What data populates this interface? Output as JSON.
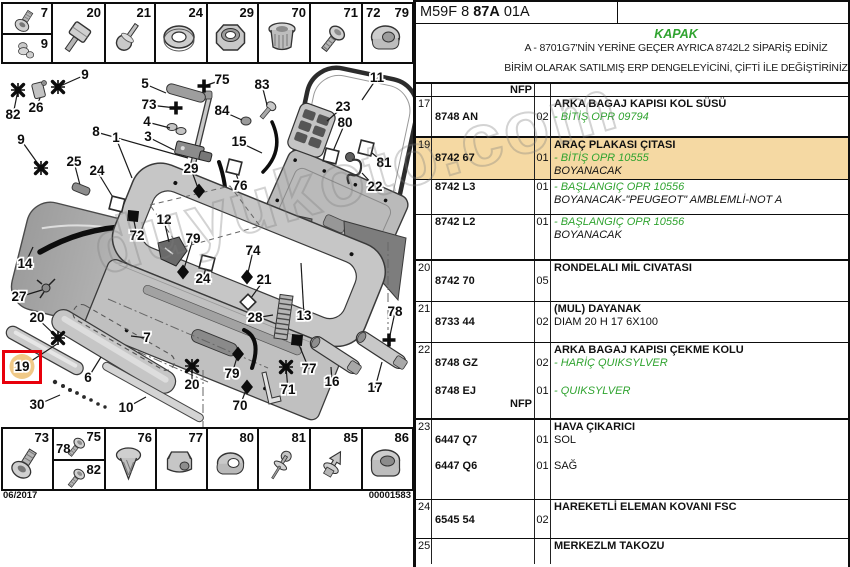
{
  "watermark": {
    "text": "duyukoto.com"
  },
  "header": {
    "code_prefix": "M59F 8 ",
    "code_bold": "87A",
    "code_suffix": " 01A"
  },
  "title_block": {
    "title": "KAPAK",
    "title_color": "#2fa32f",
    "note1": "A - 8701G7'NİN YERİNE GEÇER AYRICA 8742L2 SİPARİŞ EDİNİZ",
    "note2": "BİRİM OLARAK SATILMIŞ ERP DENGELEYİCİNİ, ÇİFTİ İLE DEĞİŞTİRİNİZ"
  },
  "parts_table": {
    "green": "#2fa32f",
    "highlight": "#f5d9a3",
    "nfp_label": "NFP",
    "rows": [
      {
        "ref": "17",
        "part": "8748 AN",
        "qty": "02",
        "titled": true,
        "h": 41,
        "bb": 2,
        "lines": [
          [
            "k",
            "ARKA BAGAJ KAPISI KOL SÜSÜ"
          ],
          [
            "g",
            "- BİTİŞ OPR 09794"
          ]
        ]
      },
      {
        "ref": "19",
        "part": "8742 67",
        "qty": "01",
        "titled": true,
        "h": 42,
        "bb": 1,
        "hl": true,
        "lines": [
          [
            "k",
            "ARAÇ PLAKASI ÇITASI"
          ],
          [
            "g",
            "- BİTİŞ OPR 10555"
          ],
          [
            "i",
            "BOYANACAK"
          ]
        ]
      },
      {
        "part": "8742 L3",
        "qty": "01",
        "h": 35,
        "bb": 1,
        "lines": [
          [
            "g",
            "- BAŞLANGIÇ OPR 10556"
          ],
          [
            "i",
            "BOYANACAK-\"PEUGEOT\" AMBLEMLİ-NOT A"
          ]
        ]
      },
      {
        "part": "8742 L2",
        "qty": "01",
        "h": 46,
        "bb": 2,
        "lines": [
          [
            "g",
            "- BAŞLANGIÇ OPR 10556"
          ],
          [
            "i",
            "BOYANACAK"
          ]
        ]
      },
      {
        "ref": "20",
        "part": "8742 70",
        "qty": "05",
        "titled": true,
        "h": 41,
        "bb": 1,
        "lines": [
          [
            "k",
            "RONDELALI MİL CIVATASI"
          ]
        ]
      },
      {
        "ref": "21",
        "part": "8733 44",
        "qty": "02",
        "titled": true,
        "h": 41,
        "bb": 1,
        "lines": [
          [
            "k",
            "(MUL) DAYANAK"
          ],
          [
            "n",
            "DIAM 20 H 17 6X100"
          ]
        ]
      },
      {
        "ref": "22",
        "part": "8748 GZ",
        "qty": "02",
        "titled": true,
        "h": 41,
        "bb": 0,
        "lines": [
          [
            "k",
            "ARKA BAGAJ KAPISI ÇEKME KOLU"
          ],
          [
            "g",
            "- HARİÇ QUIKSYLVER"
          ]
        ]
      },
      {
        "part": "8748 EJ",
        "qty": "01",
        "nfp": true,
        "h": 36,
        "bb": 2,
        "lines": [
          [
            "g",
            "- QUIKSYLVER"
          ]
        ]
      },
      {
        "ref": "23",
        "part": "6447 Q7",
        "qty": "01",
        "titled": true,
        "h": 39,
        "bb": 0,
        "lines": [
          [
            "k",
            "HAVA ÇIKARICI"
          ],
          [
            "n",
            "SOL"
          ]
        ]
      },
      {
        "part": "6447 Q6",
        "qty": "01",
        "h": 41,
        "bb": 1,
        "lines": [
          [
            "n",
            "SAĞ"
          ]
        ]
      },
      {
        "ref": "24",
        "part": "6545 54",
        "qty": "02",
        "titled": true,
        "h": 39,
        "bb": 1,
        "lines": [
          [
            "k",
            "HAREKETLİ ELEMAN KOVANI FSC"
          ]
        ]
      },
      {
        "ref": "25",
        "titled": true,
        "h": 25,
        "bb": 0,
        "lines": [
          [
            "k",
            "MERKEZLM TAKOZU"
          ]
        ]
      }
    ]
  },
  "diagram": {
    "sheet_date": "06/2017",
    "sheet_number": "00001583",
    "highlight_color": "#f0c987",
    "top_fasteners": [
      {
        "x": 2,
        "w": 50,
        "split": [
          {
            "label": "7",
            "icon": "socketbolt"
          },
          {
            "label": "9",
            "icon": "stud"
          }
        ]
      },
      {
        "x": 52,
        "w": 53,
        "label": "20",
        "icon": "squarebolt"
      },
      {
        "x": 105,
        "w": 50,
        "label": "21",
        "icon": "pin"
      },
      {
        "x": 155,
        "w": 52,
        "label": "24",
        "icon": "washer"
      },
      {
        "x": 207,
        "w": 51,
        "label": "29",
        "icon": "hexnut"
      },
      {
        "x": 258,
        "w": 52,
        "label": "70",
        "icon": "cage"
      },
      {
        "x": 310,
        "w": 52,
        "label": "71",
        "icon": "screw"
      },
      {
        "x": 362,
        "w": 51,
        "labels": [
          "72",
          "79"
        ],
        "icon": "flange"
      }
    ],
    "bottom_fasteners": [
      {
        "x": 2,
        "w": 51,
        "label": "73",
        "icon": "socketbolt"
      },
      {
        "x": 53,
        "w": 52,
        "split": [
          {
            "labels": [
              "75",
              "78"
            ],
            "icon": "screw"
          },
          {
            "label": "82",
            "icon": "screw"
          }
        ]
      },
      {
        "x": 105,
        "w": 51,
        "label": "76",
        "icon": "expander"
      },
      {
        "x": 156,
        "w": 51,
        "label": "77",
        "icon": "plasticnut"
      },
      {
        "x": 207,
        "w": 51,
        "label": "80",
        "icon": "grommet"
      },
      {
        "x": 258,
        "w": 52,
        "label": "81",
        "icon": "rivet"
      },
      {
        "x": 310,
        "w": 52,
        "label": "85",
        "icon": "pushpin"
      },
      {
        "x": 362,
        "w": 51,
        "label": "86",
        "icon": "bushing"
      }
    ],
    "callouts": [
      {
        "n": "1",
        "x": 116,
        "y": 142,
        "tx": 132,
        "ty": 178
      },
      {
        "n": "3",
        "x": 148,
        "y": 141,
        "tx": 174,
        "ty": 150
      },
      {
        "n": "4",
        "x": 147,
        "y": 126,
        "tx": 170,
        "ty": 128
      },
      {
        "n": "5",
        "x": 145,
        "y": 88,
        "tx": 166,
        "ty": 93
      },
      {
        "n": "6",
        "x": 88,
        "y": 382,
        "tx": 101,
        "ty": 357
      },
      {
        "n": "7",
        "x": 147,
        "y": 342,
        "tx": 131,
        "ty": 336
      },
      {
        "n": "8",
        "x": 96,
        "y": 136,
        "tx": 188,
        "ty": 158
      },
      {
        "n": "9",
        "x": 85,
        "y": 79,
        "s": "star",
        "tx": 58,
        "ty": 87
      },
      {
        "n": "9",
        "x": 21,
        "y": 144,
        "s": "star",
        "tx": 41,
        "ty": 168
      },
      {
        "n": "10",
        "x": 126,
        "y": 412,
        "tx": 146,
        "ty": 397
      },
      {
        "n": "11",
        "x": 377,
        "y": 82,
        "tx": 362,
        "ty": 100
      },
      {
        "n": "12",
        "x": 164,
        "y": 224,
        "tx": 169,
        "ty": 242
      },
      {
        "n": "13",
        "x": 304,
        "y": 320,
        "tx": 301,
        "ty": 263
      },
      {
        "n": "14",
        "x": 25,
        "y": 268,
        "tx": 33,
        "ty": 247
      },
      {
        "n": "15",
        "x": 239,
        "y": 146,
        "tx": 262,
        "ty": 153
      },
      {
        "n": "16",
        "x": 332,
        "y": 386,
        "tx": 331,
        "ty": 367
      },
      {
        "n": "17",
        "x": 375,
        "y": 392,
        "tx": 382,
        "ty": 362
      },
      {
        "n": "19",
        "x": 22,
        "y": 371,
        "hl": true,
        "tx": 57,
        "ty": 344
      },
      {
        "n": "20",
        "x": 37,
        "y": 322,
        "s": "star",
        "tx": 58,
        "ty": 338
      },
      {
        "n": "20",
        "x": 192,
        "y": 389,
        "s": "star",
        "tx": 192,
        "ty": 366
      },
      {
        "n": "21",
        "x": 264,
        "y": 284,
        "s": "rhomb",
        "tx": 248,
        "ty": 302
      },
      {
        "n": "22",
        "x": 375,
        "y": 191,
        "tx": 362,
        "ty": 173
      },
      {
        "n": "23",
        "x": 343,
        "y": 111,
        "tx": 327,
        "ty": 121
      },
      {
        "n": "24",
        "x": 97,
        "y": 175,
        "s": "osq",
        "tx": 117,
        "ty": 204
      },
      {
        "n": "24",
        "x": 203,
        "y": 283,
        "s": "osq",
        "tx": 207,
        "ty": 263
      },
      {
        "n": "25",
        "x": 74,
        "y": 166,
        "s": "bar",
        "tx": 81,
        "ty": 189
      },
      {
        "n": "26",
        "x": 36,
        "y": 112,
        "tx": 40,
        "ty": 98
      },
      {
        "n": "27",
        "x": 19,
        "y": 301,
        "tx": 42,
        "ty": 290
      },
      {
        "n": "28",
        "x": 255,
        "y": 322,
        "tx": 273,
        "ty": 315
      },
      {
        "n": "29",
        "x": 191,
        "y": 173,
        "s": "diam",
        "tx": 199,
        "ty": 191
      },
      {
        "n": "30",
        "x": 37,
        "y": 409,
        "tx": 60,
        "ty": 395
      },
      {
        "n": "70",
        "x": 240,
        "y": 410,
        "s": "diam",
        "tx": 247,
        "ty": 387
      },
      {
        "n": "71",
        "x": 288,
        "y": 394,
        "s": "star",
        "tx": 286,
        "ty": 367
      },
      {
        "n": "72",
        "x": 137,
        "y": 240,
        "s": "fsq",
        "tx": 133,
        "ty": 216
      },
      {
        "n": "73",
        "x": 149,
        "y": 109,
        "s": "cross",
        "tx": 176,
        "ty": 108
      },
      {
        "n": "74",
        "x": 253,
        "y": 255,
        "s": "diam",
        "tx": 247,
        "ty": 277
      },
      {
        "n": "75",
        "x": 222,
        "y": 84,
        "s": "cross",
        "tx": 204,
        "ty": 86
      },
      {
        "n": "76",
        "x": 240,
        "y": 190,
        "s": "osq",
        "tx": 234,
        "ty": 167
      },
      {
        "n": "77",
        "x": 309,
        "y": 373,
        "s": "fsq",
        "tx": 297,
        "ty": 340
      },
      {
        "n": "78",
        "x": 395,
        "y": 316,
        "s": "cross",
        "tx": 389,
        "ty": 340
      },
      {
        "n": "79",
        "x": 193,
        "y": 243,
        "s": "diam",
        "tx": 183,
        "ty": 272
      },
      {
        "n": "79",
        "x": 232,
        "y": 378,
        "s": "diam",
        "tx": 238,
        "ty": 354
      },
      {
        "n": "80",
        "x": 345,
        "y": 127,
        "s": "osq",
        "tx": 331,
        "ty": 156
      },
      {
        "n": "81",
        "x": 384,
        "y": 167,
        "s": "osq",
        "tx": 366,
        "ty": 148
      },
      {
        "n": "82",
        "x": 13,
        "y": 119,
        "s": "star",
        "tx": 18,
        "ty": 90
      },
      {
        "n": "83",
        "x": 262,
        "y": 89,
        "tx": 267,
        "ty": 105
      },
      {
        "n": "84",
        "x": 222,
        "y": 115,
        "tx": 242,
        "ty": 120
      }
    ]
  }
}
